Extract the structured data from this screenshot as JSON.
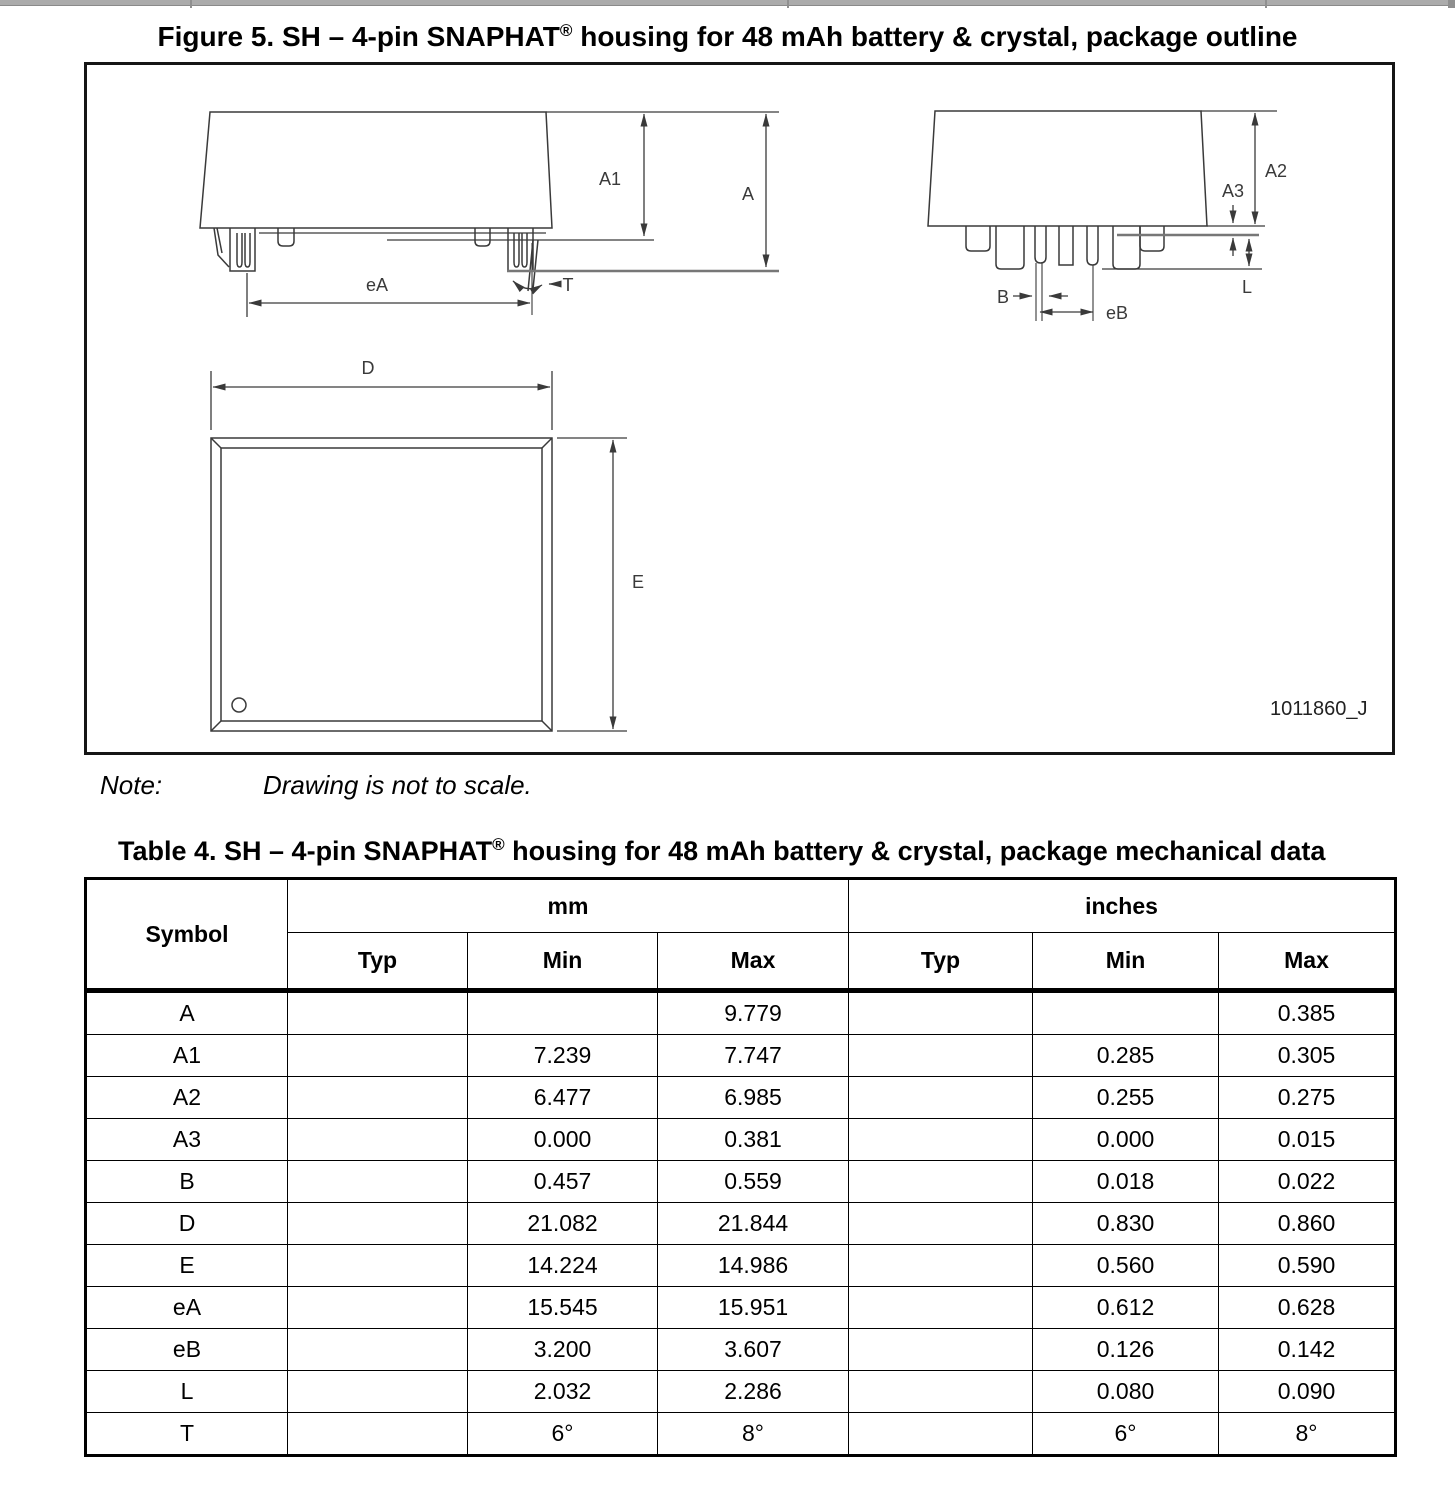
{
  "figure": {
    "title_main": "Figure 5. SH – 4-pin SNAPHAT",
    "title_reg": "®",
    "title_tail": " housing for 48 mAh battery & crystal, package outline",
    "drawing_code": "1011860_J",
    "labels": {
      "a1": "A1",
      "a": "A",
      "ea": "eA",
      "t": "T",
      "a2": "A2",
      "a3": "A3",
      "l": "L",
      "b": "B",
      "eb": "eB",
      "d": "D",
      "e": "E"
    }
  },
  "note": {
    "label": "Note:",
    "text": "Drawing is not to scale."
  },
  "table": {
    "title_main": "Table 4. SH – 4-pin SNAPHAT",
    "title_reg": "®",
    "title_tail": " housing for 48 mAh battery & crystal, package mechanical data",
    "symbol_header": "Symbol",
    "col_groups": [
      "mm",
      "inches"
    ],
    "sub_headers": [
      "Typ",
      "Min",
      "Max",
      "Typ",
      "Min",
      "Max"
    ],
    "rows": [
      {
        "cells": [
          "A",
          "",
          "",
          "9.779",
          "",
          "",
          "0.385"
        ]
      },
      {
        "cells": [
          "A1",
          "",
          "7.239",
          "7.747",
          "",
          "0.285",
          "0.305"
        ]
      },
      {
        "cells": [
          "A2",
          "",
          "6.477",
          "6.985",
          "",
          "0.255",
          "0.275"
        ]
      },
      {
        "cells": [
          "A3",
          "",
          "0.000",
          "0.381",
          "",
          "0.000",
          "0.015"
        ]
      },
      {
        "cells": [
          "B",
          "",
          "0.457",
          "0.559",
          "",
          "0.018",
          "0.022"
        ]
      },
      {
        "cells": [
          "D",
          "",
          "21.082",
          "21.844",
          "",
          "0.830",
          "0.860"
        ]
      },
      {
        "cells": [
          "E",
          "",
          "14.224",
          "14.986",
          "",
          "0.560",
          "0.590"
        ]
      },
      {
        "cells": [
          "eA",
          "",
          "15.545",
          "15.951",
          "",
          "0.612",
          "0.628"
        ]
      },
      {
        "cells": [
          "eB",
          "",
          "3.200",
          "3.607",
          "",
          "0.126",
          "0.142"
        ]
      },
      {
        "cells": [
          "L",
          "",
          "2.032",
          "2.286",
          "",
          "0.080",
          "0.090"
        ]
      },
      {
        "cells": [
          "T",
          "",
          "6°",
          "8°",
          "",
          "6°",
          "8°"
        ]
      }
    ]
  }
}
